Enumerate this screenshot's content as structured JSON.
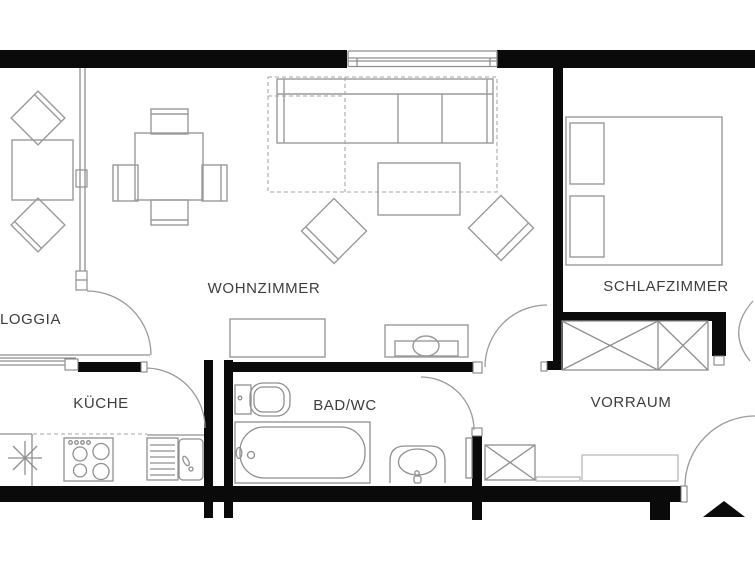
{
  "colors": {
    "bg": "#ffffff",
    "wall": "#0a0a0a",
    "line": "#9a9a9a",
    "fixture": "#8f8f8f",
    "light": "#b5b5b5",
    "dash": "#a5a5a5",
    "frame": "#7a7a7a",
    "text": "#3d3d3d"
  },
  "floorplan": {
    "rooms": {
      "loggia": {
        "label": "LOGGIA"
      },
      "wohnzimmer": {
        "label": "WOHNZIMMER"
      },
      "schlafzimmer": {
        "label": "SCHLAFZIMMER"
      },
      "kueche": {
        "label": "KÜCHE"
      },
      "bad_wc": {
        "label": "BAD/WC"
      },
      "vorraum": {
        "label": "VORRAUM"
      }
    },
    "markers": {
      "entrance": "filled-triangle-up"
    }
  }
}
